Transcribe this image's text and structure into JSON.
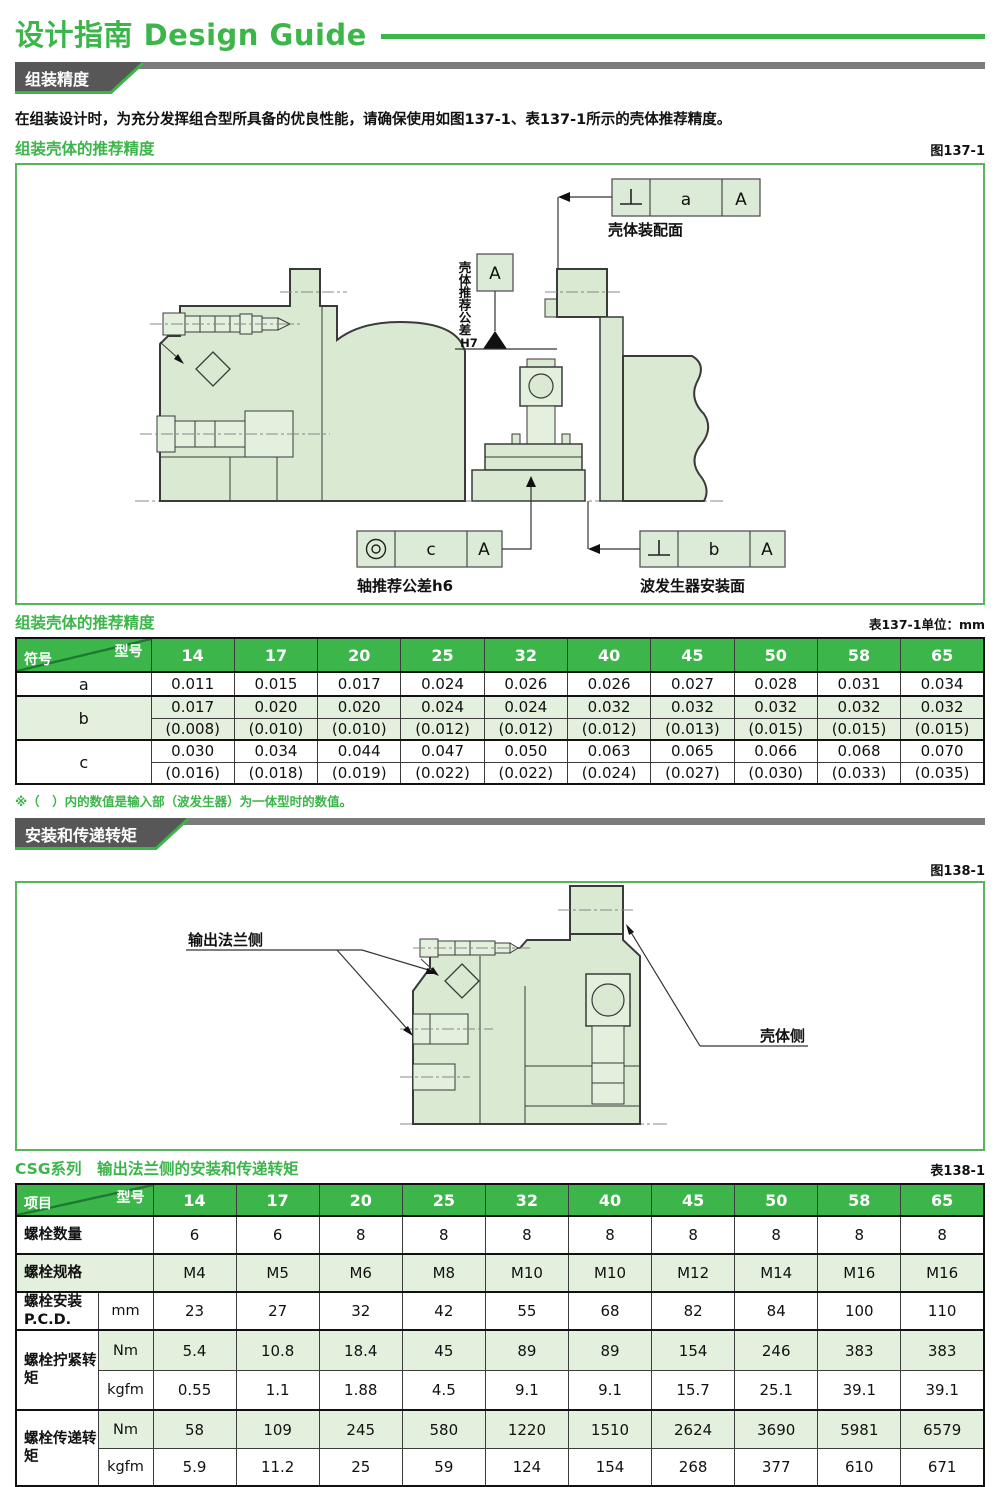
{
  "page": {
    "title": "设计指南 Design Guide"
  },
  "models": [
    "14",
    "17",
    "20",
    "25",
    "32",
    "40",
    "45",
    "50",
    "58",
    "65"
  ],
  "section1": {
    "banner": "组装精度",
    "intro": "在组装设计时，为充分发挥组合型所具备的优良性能，请确保使用如图137-1、表137-1所示的壳体推荐精度。",
    "figure": {
      "heading": "组装壳体的推荐精度",
      "ref": "图137-1",
      "labels": {
        "housing_mount_face": "壳体装配面",
        "housing_tol": "壳体推荐公差",
        "housing_tol_grade": "H7",
        "datum": "A",
        "fcf_a_value": "a",
        "fcf_a_datum": "A",
        "fcf_b_value": "b",
        "fcf_b_datum": "A",
        "fcf_c_value": "c",
        "fcf_c_datum": "A",
        "shaft_tol": "轴推荐公差h6",
        "wg_mount_face": "波发生器安装面"
      }
    },
    "table": {
      "title": "组装壳体的推荐精度",
      "ref": "表137-1单位：mm",
      "corner_top": "型号",
      "corner_bottom": "符号",
      "rows": {
        "a": {
          "label": "a",
          "values": [
            "0.011",
            "0.015",
            "0.017",
            "0.024",
            "0.026",
            "0.026",
            "0.027",
            "0.028",
            "0.031",
            "0.034"
          ]
        },
        "b": {
          "label": "b",
          "values": [
            "0.017",
            "0.020",
            "0.020",
            "0.024",
            "0.024",
            "0.032",
            "0.032",
            "0.032",
            "0.032",
            "0.032"
          ],
          "paren": [
            "(0.008)",
            "(0.010)",
            "(0.010)",
            "(0.012)",
            "(0.012)",
            "(0.012)",
            "(0.013)",
            "(0.015)",
            "(0.015)",
            "(0.015)"
          ]
        },
        "c": {
          "label": "c",
          "values": [
            "0.030",
            "0.034",
            "0.044",
            "0.047",
            "0.050",
            "0.063",
            "0.065",
            "0.066",
            "0.068",
            "0.070"
          ],
          "paren": [
            "(0.016)",
            "(0.018)",
            "(0.019)",
            "(0.022)",
            "(0.022)",
            "(0.024)",
            "(0.027)",
            "(0.030)",
            "(0.033)",
            "(0.035)"
          ]
        }
      },
      "note": "※（　）内的数值是输入部（波发生器）为一体型时的数值。"
    }
  },
  "section2": {
    "banner": "安装和传递转矩",
    "figure": {
      "ref": "图138-1",
      "labels": {
        "output_flange": "输出法兰侧",
        "housing": "壳体侧"
      }
    },
    "table": {
      "title": "CSG系列　输出法兰侧的安装和传递转矩",
      "ref": "表138-1",
      "corner_top": "型号",
      "corner_bottom": "项目",
      "rows": {
        "qty": {
          "label": "螺栓数量",
          "values": [
            "6",
            "6",
            "8",
            "8",
            "8",
            "8",
            "8",
            "8",
            "8",
            "8"
          ]
        },
        "spec": {
          "label": "螺栓规格",
          "values": [
            "M4",
            "M5",
            "M6",
            "M8",
            "M10",
            "M10",
            "M12",
            "M14",
            "M16",
            "M16"
          ]
        },
        "pcd": {
          "label": "螺栓安装P.C.D.",
          "unit": "mm",
          "values": [
            "23",
            "27",
            "32",
            "42",
            "55",
            "68",
            "82",
            "84",
            "100",
            "110"
          ]
        },
        "tighten": {
          "label": "螺栓拧紧转矩",
          "nm": {
            "unit": "Nm",
            "values": [
              "5.4",
              "10.8",
              "18.4",
              "45",
              "89",
              "89",
              "154",
              "246",
              "383",
              "383"
            ]
          },
          "kgfm": {
            "unit": "kgfm",
            "values": [
              "0.55",
              "1.1",
              "1.88",
              "4.5",
              "9.1",
              "9.1",
              "15.7",
              "25.1",
              "39.1",
              "39.1"
            ]
          }
        },
        "transmit": {
          "label": "螺栓传递转矩",
          "nm": {
            "unit": "Nm",
            "values": [
              "58",
              "109",
              "245",
              "580",
              "1220",
              "1510",
              "2624",
              "3690",
              "5981",
              "6579"
            ]
          },
          "kgfm": {
            "unit": "kgfm",
            "values": [
              "5.9",
              "11.2",
              "25",
              "59",
              "124",
              "154",
              "268",
              "377",
              "610",
              "671"
            ]
          }
        }
      }
    }
  }
}
